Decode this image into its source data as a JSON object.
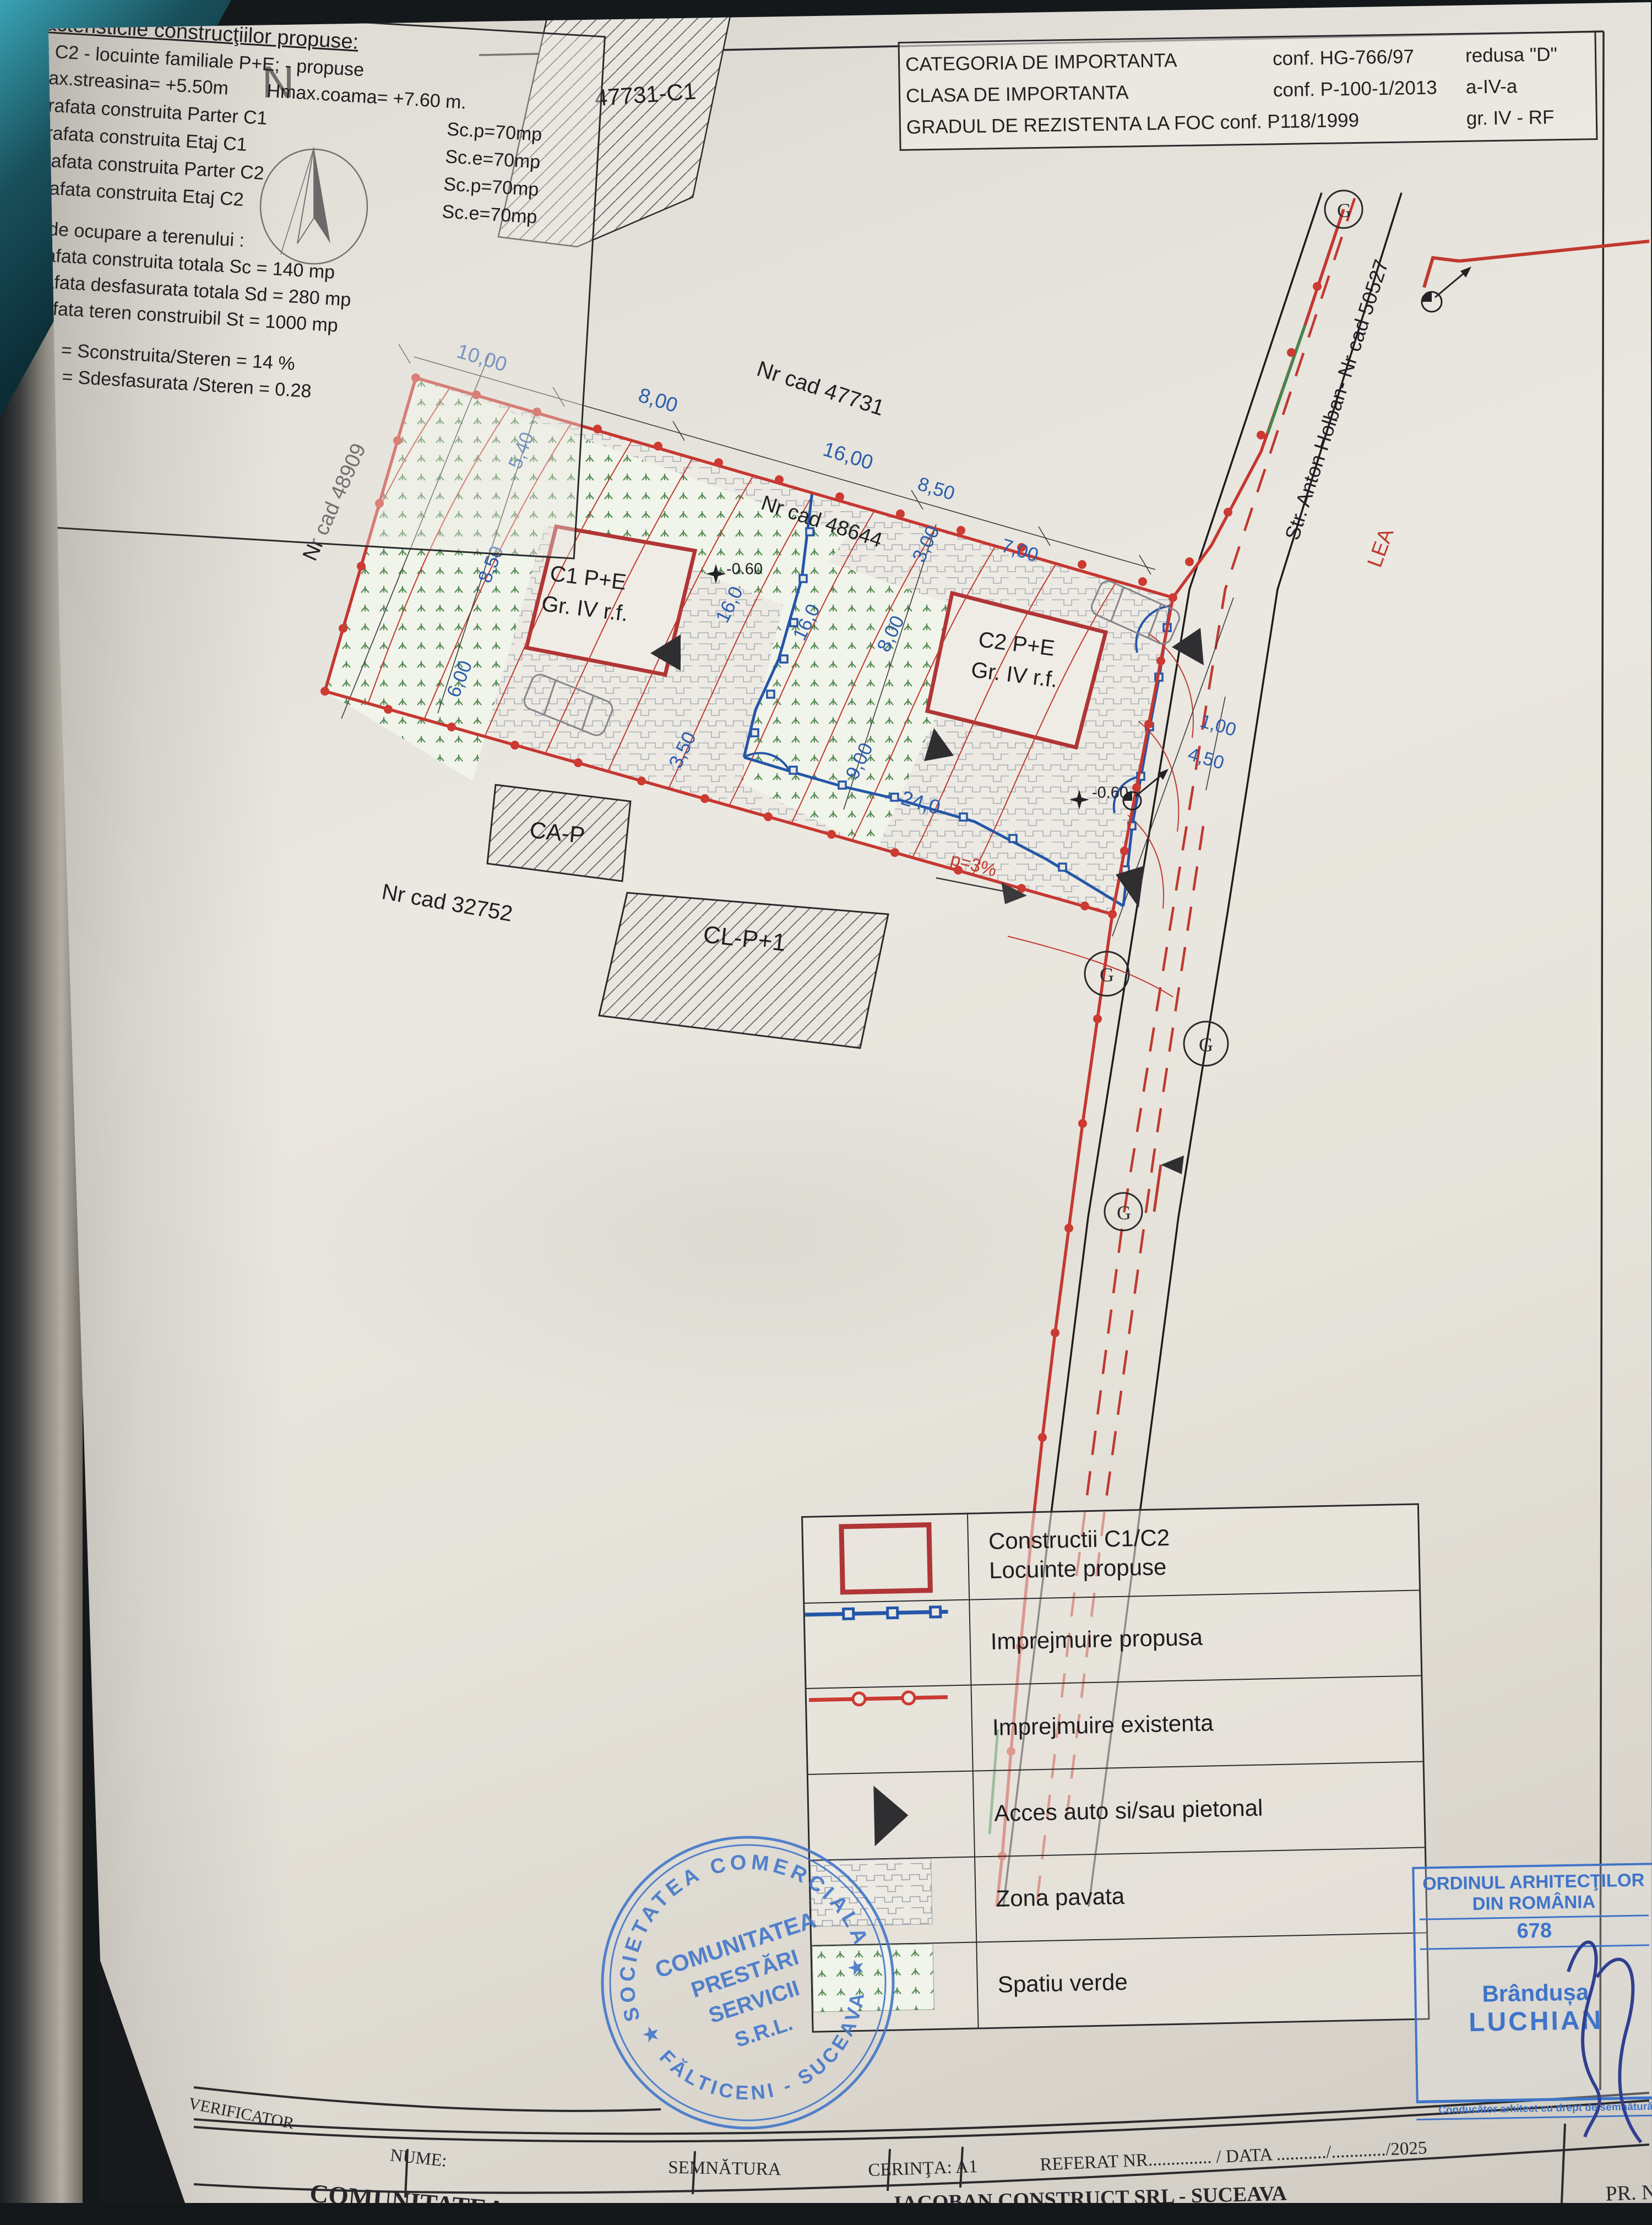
{
  "importance_box": {
    "rows": [
      {
        "label": "CATEGORIA DE IMPORTANTA",
        "ref": "conf. HG-766/97",
        "value": "redusa \"D\""
      },
      {
        "label": "CLASA DE IMPORTANTA",
        "ref": "conf. P-100-1/2013",
        "value": "a-IV-a"
      },
      {
        "label": "GRADUL DE REZISTENTA LA FOC conf. P118/1999",
        "ref": "",
        "value": "gr. IV - RF"
      }
    ]
  },
  "plan": {
    "north": "N",
    "cad_top_building": "47731-C1",
    "cad_main": "Nr cad 47731",
    "cad_mid": "Nr cad 48644",
    "cad_left": "Nr cad 48909",
    "cad_bottom": "Nr cad 32752",
    "street": "Str. Anton Holban- Nr cad 50527",
    "lea": "LEA",
    "c1_line1": "C1 P+E",
    "c1_line2": "Gr. IV r.f.",
    "c2_line1": "C2 P+E",
    "c2_line2": "Gr. IV r.f.",
    "ca_p": "CA-P",
    "cl_p1": "CL-P+1",
    "slope": "p=3%",
    "elev1": "-0.60",
    "elev2": "-0.60",
    "dims": {
      "d10": "10,00",
      "d8": "8,00",
      "d16": "16,00",
      "d85": "8,50",
      "d7": "7,00",
      "l54": "5,40",
      "l85": "8,50",
      "l6": "6,00",
      "i16a": "16,0",
      "i16b": "16,0",
      "i8": "8,00",
      "i9": "9,00",
      "i3": "3,00",
      "i35": "3,50",
      "i24": "24,0",
      "r1": "1,00",
      "r45": "4,50"
    },
    "symbols": {
      "g": "G"
    }
  },
  "legend": {
    "rows": [
      {
        "label1": "Constructii C1/C2",
        "label2": "Locuinte propuse"
      },
      {
        "label1": "Imprejmuire propusa",
        "label2": ""
      },
      {
        "label1": "Imprejmuire existenta",
        "label2": ""
      },
      {
        "label1": "Acces auto si/sau pietonal",
        "label2": ""
      },
      {
        "label1": "Zona pavata",
        "label2": ""
      },
      {
        "label1": "Spatiu verde",
        "label2": ""
      }
    ]
  },
  "characteristics": {
    "title": "Caracteristicile construcţiilor propuse:",
    "line1": "C1 = C2 - locuinte familiale P+E; - propuse",
    "hmax1": "- Hmax.streasina= +5.50m",
    "hmax2": "Hmax.coama= +7.60 m.",
    "items": [
      {
        "label": "- suprafata construita Parter C1",
        "value": "Sc.p=70mp"
      },
      {
        "label": "- suprafata construita Etaj C1",
        "value": "Sc.e=70mp"
      },
      {
        "label": "- suprafata construita Parter C2",
        "value": "Sc.p=70mp"
      },
      {
        "label": "- suprafata construita Etaj C2",
        "value": "Sc.e=70mp"
      }
    ],
    "indici_title": "Indici de ocupare a terenului :",
    "indici": [
      "- suprafata construita totala  Sc = 140 mp",
      "- suprafata desfasurata totala  Sd = 280 mp",
      "- suprafata teren construibil St = 1000 mp"
    ],
    "pot": "P.O.T. = Sconstruita/Steren =  14 %",
    "cut": "C.U.T. = Sdesfasurata /Steren = 0.28"
  },
  "stamps": {
    "round": {
      "arc_top": "SOCIETATEA COMERCIALA",
      "arc_bottom": "FĂLTICENI - SUCEAVA",
      "star_left": "★",
      "star_right": "★",
      "line1": "COMUNITATEA",
      "line2": "PRESTĂRI",
      "line3": "SERVICII",
      "line4": "S.R.L."
    },
    "oar": {
      "line1": "ORDINUL ARHITECŢILOR",
      "line2": "DIN ROMÂNIA",
      "number": "678",
      "name1": "Brândușa",
      "name2": "LUCHIAN",
      "footer": "Conducător arhitect cu drept de semnătură"
    }
  },
  "title_block": {
    "verificator": "VERIFICATOR",
    "nume": "NUME:",
    "semnatura": "SEMNĂTURA",
    "cerinta": "CERINŢA: A1",
    "referat": "REFERAT NR",
    "dots1": "..............",
    "data_label": "/ DATA",
    "dots2": ".........../............/",
    "year": "2025",
    "comunitatea": "COMUNITATEA",
    "firm": "IACOBAN CONSTRUCT SRL - SUCEAVA",
    "pr": "PR. N"
  }
}
